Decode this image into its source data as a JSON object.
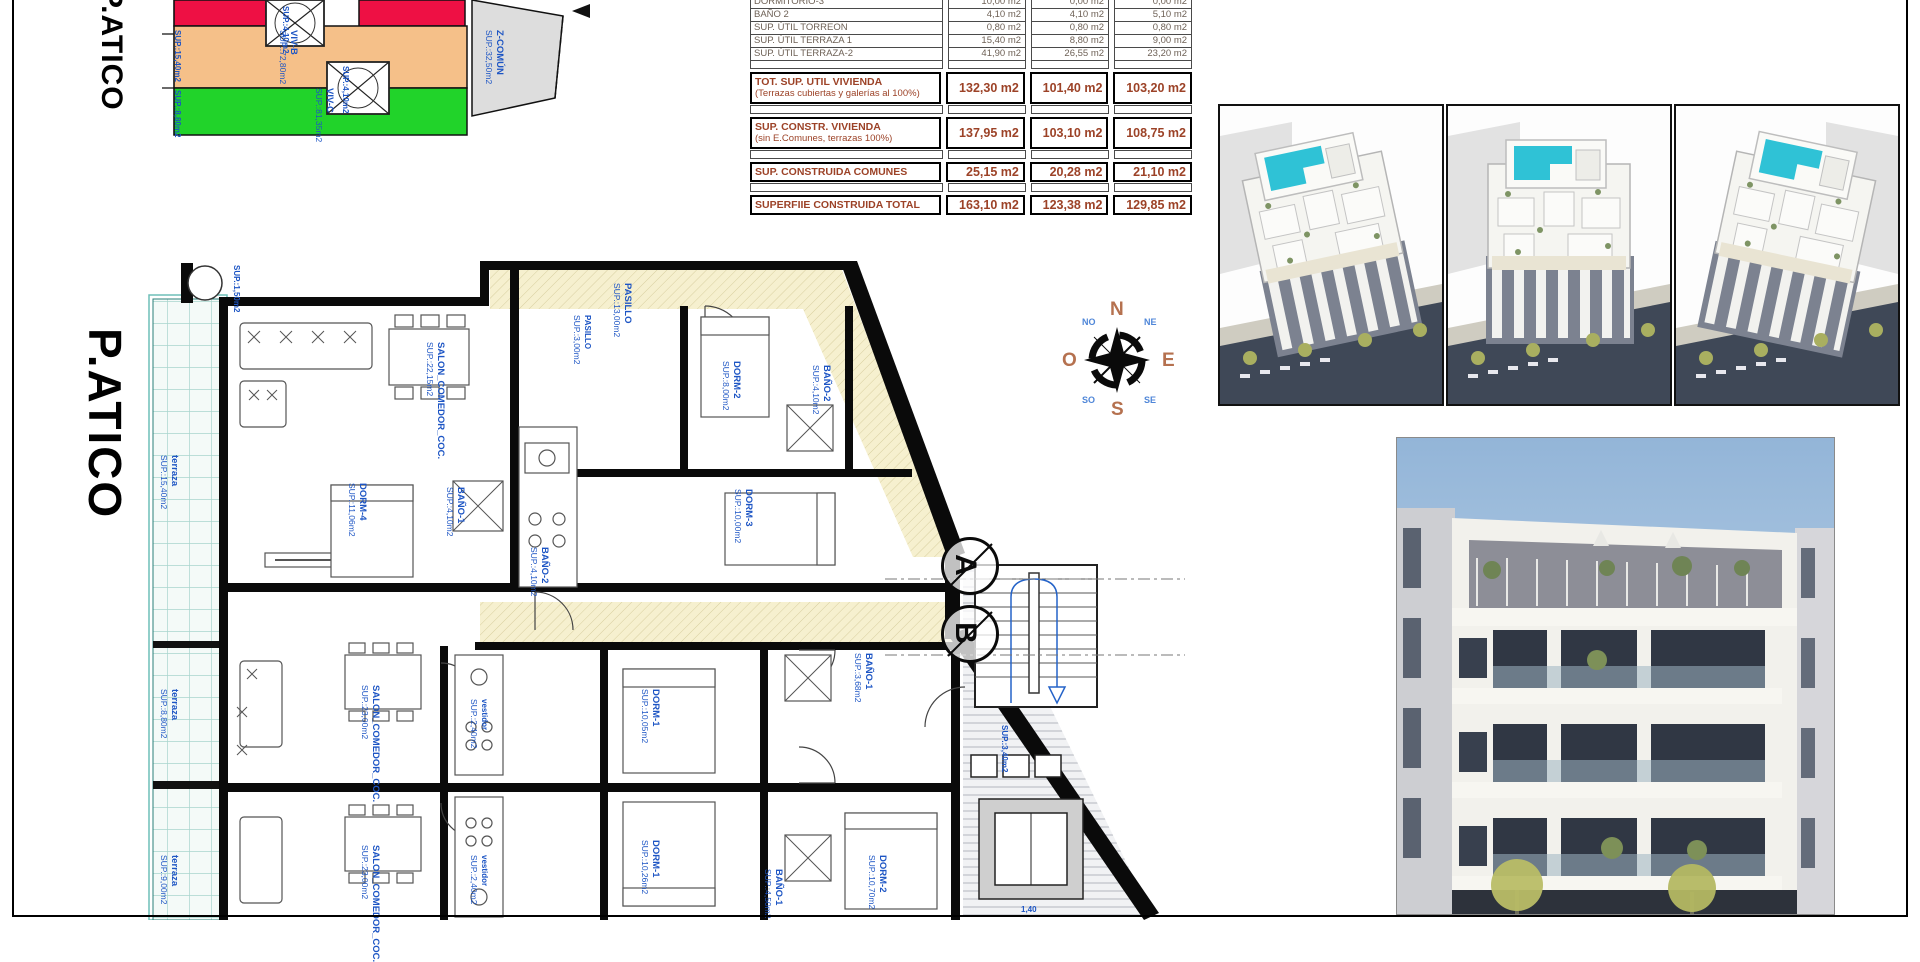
{
  "sheet": {
    "floor_title": "P.ATICO",
    "mini_plan_title": "P.ATICO"
  },
  "site_plan": {
    "labels": [
      {
        "t": "VIV-B",
        "s": "SUP.:72,80m2",
        "x": 176,
        "y": 30,
        "r": 90
      },
      {
        "t": "VIV-C",
        "s": "SUP.:81,35m2",
        "x": 212,
        "y": 88,
        "r": 90
      },
      {
        "t": "Z-COMÚN",
        "s": "SUP.:32,50m2",
        "x": 382,
        "y": 30,
        "r": 90
      },
      {
        "t": "SUP.:15,40m2",
        "x": 60,
        "y": 30,
        "r": 90,
        "small": true
      },
      {
        "t": "SUP.:8,80m2",
        "x": 60,
        "y": 90,
        "r": 90,
        "small": true
      },
      {
        "t": "SUP.:4,10m2",
        "x": 168,
        "y": 6,
        "r": 90,
        "small": true
      },
      {
        "t": "SUP.:4,10m2",
        "x": 228,
        "y": 66,
        "r": 90,
        "small": true
      }
    ]
  },
  "area_table": {
    "rows": [
      {
        "type": "small",
        "label": "DORMITORIO-3",
        "values": [
          "10,00 m2",
          "0,00 m2",
          "0,00 m2"
        ]
      },
      {
        "type": "small",
        "label": "BAÑO 2",
        "values": [
          "4,10 m2",
          "4,10 m2",
          "5,10 m2"
        ]
      },
      {
        "type": "small",
        "label": "SUP. ÚTIL TORREON",
        "values": [
          "0,80 m2",
          "0,80 m2",
          "0,80 m2"
        ]
      },
      {
        "type": "small",
        "label": "SUP. ÚTIL TERRAZA 1",
        "values": [
          "15,40 m2",
          "8,80 m2",
          "9,00 m2"
        ]
      },
      {
        "type": "small",
        "label": "SUP. ÚTIL TERRAZA-2",
        "values": [
          "41,90 m2",
          "26,55 m2",
          "23,20 m2"
        ]
      },
      {
        "type": "sp",
        "label": "",
        "values": [
          "",
          "",
          ""
        ]
      },
      {
        "type": "bold",
        "label": "TOT. SUP. UTIL VIVIENDA",
        "sub": "(Terrazas cubiertas y galerías al 100%)",
        "values": [
          "132,30 m2",
          "101,40 m2",
          "103,20 m2"
        ]
      },
      {
        "type": "sp",
        "label": "",
        "values": [
          "",
          "",
          ""
        ]
      },
      {
        "type": "bold",
        "label": "SUP. CONSTR. VIVIENDA",
        "sub": "(sin E.Comunes, terrazas 100%)",
        "values": [
          "137,95 m2",
          "103,10 m2",
          "108,75 m2"
        ]
      },
      {
        "type": "sp",
        "label": "",
        "values": [
          "",
          "",
          ""
        ]
      },
      {
        "type": "bold",
        "label": "SUP. CONSTRUIDA COMUNES",
        "values": [
          "25,15 m2",
          "20,28 m2",
          "21,10 m2"
        ]
      },
      {
        "type": "sp",
        "label": "",
        "values": [
          "",
          "",
          ""
        ]
      },
      {
        "type": "bold",
        "label": "SUPERFIIE CONSTRUIDA TOTAL",
        "values": [
          "163,10 m2",
          "123,38 m2",
          "129,85 m2"
        ]
      }
    ]
  },
  "plan_labels": [
    {
      "t": "SALON_COMEDOR_COC.",
      "s": "SUP.:22,15m2",
      "x": 300,
      "y": 85,
      "r": 90
    },
    {
      "t": "PASILLO",
      "s": "SUP.:13,00m2",
      "x": 487,
      "y": 26,
      "r": 90
    },
    {
      "t": "PASILLO",
      "s": "SUP.:3,00m2",
      "x": 447,
      "y": 58,
      "r": 90,
      "small": true
    },
    {
      "t": "DORM-2",
      "s": "SUP.:8,00m2",
      "x": 596,
      "y": 104,
      "r": 90
    },
    {
      "t": "BAÑO-2",
      "s": "SUP.:4,10m2",
      "x": 686,
      "y": 108,
      "r": 90
    },
    {
      "t": "SUP.:1,50m2",
      "x": 96,
      "y": 8,
      "r": 90,
      "small": true
    },
    {
      "t": "terraza",
      "s": "SUP.:15,40m2",
      "x": 34,
      "y": 198,
      "r": 90
    },
    {
      "t": "DORM-4",
      "s": "SUP.:11,06m2",
      "x": 222,
      "y": 226,
      "r": 90
    },
    {
      "t": "BAÑO-1",
      "s": "SUP.:4,10m2",
      "x": 320,
      "y": 230,
      "r": 90
    },
    {
      "t": "BAÑO-2",
      "s": "SUP.:4,10m2",
      "x": 404,
      "y": 290,
      "r": 90
    },
    {
      "t": "DORM-3",
      "s": "SUP.:10,00m2",
      "x": 608,
      "y": 232,
      "r": 90
    },
    {
      "t": "SALON_COMEDOR_COC.",
      "s": "SUP.:23,00m2",
      "x": 235,
      "y": 428,
      "r": 90
    },
    {
      "t": "vestidor",
      "s": "SUP.:2,40m2",
      "x": 344,
      "y": 442,
      "r": 90,
      "small": true
    },
    {
      "t": "DORM-1",
      "s": "SUP.:10,05m2",
      "x": 515,
      "y": 432,
      "r": 90
    },
    {
      "t": "BAÑO-1",
      "s": "SUP.:3,68m2",
      "x": 728,
      "y": 396,
      "r": 90
    },
    {
      "t": "terraza",
      "s": "SUP.:8,80m2",
      "x": 34,
      "y": 432,
      "r": 90
    },
    {
      "t": "SALON_COMEDOR_COC.",
      "s": "SUP.:23,00m2",
      "x": 235,
      "y": 588,
      "r": 90
    },
    {
      "t": "vestidor",
      "s": "SUP.:2,40m2",
      "x": 344,
      "y": 598,
      "r": 90,
      "small": true
    },
    {
      "t": "DORM-1",
      "s": "SUP.:10,26m2",
      "x": 515,
      "y": 583,
      "r": 90
    },
    {
      "t": "BAÑO-1",
      "s": "SUP.:4,50m2",
      "x": 638,
      "y": 612,
      "r": 90
    },
    {
      "t": "DORM-2",
      "s": "SUP.:10,70m2",
      "x": 742,
      "y": 598,
      "r": 90
    },
    {
      "t": "terraza",
      "s": "SUP.:9,00m2",
      "x": 34,
      "y": 598,
      "r": 90
    },
    {
      "t": "SUP.:3,40m2",
      "x": 864,
      "y": 468,
      "r": 90,
      "small": true
    },
    {
      "t": "1,40",
      "x": 876,
      "y": 648,
      "r": 0,
      "small": true
    }
  ],
  "compass": {
    "n": "N",
    "s": "S",
    "e": "E",
    "o": "O",
    "ne": "NE",
    "no": "NO",
    "se": "SE",
    "so": "SO"
  },
  "section_markers": [
    "A",
    "B"
  ],
  "colors": {
    "viv_b_fill": "#f5c089",
    "viv_c_fill": "#21d32a",
    "red_fill": "#ee1044",
    "comun_fill": "#dddddd",
    "label_blue": "#1d55c4",
    "table_accent": "#9c4227",
    "pool": "#2fc2d6",
    "terrace_line": "#a8d4cd"
  }
}
